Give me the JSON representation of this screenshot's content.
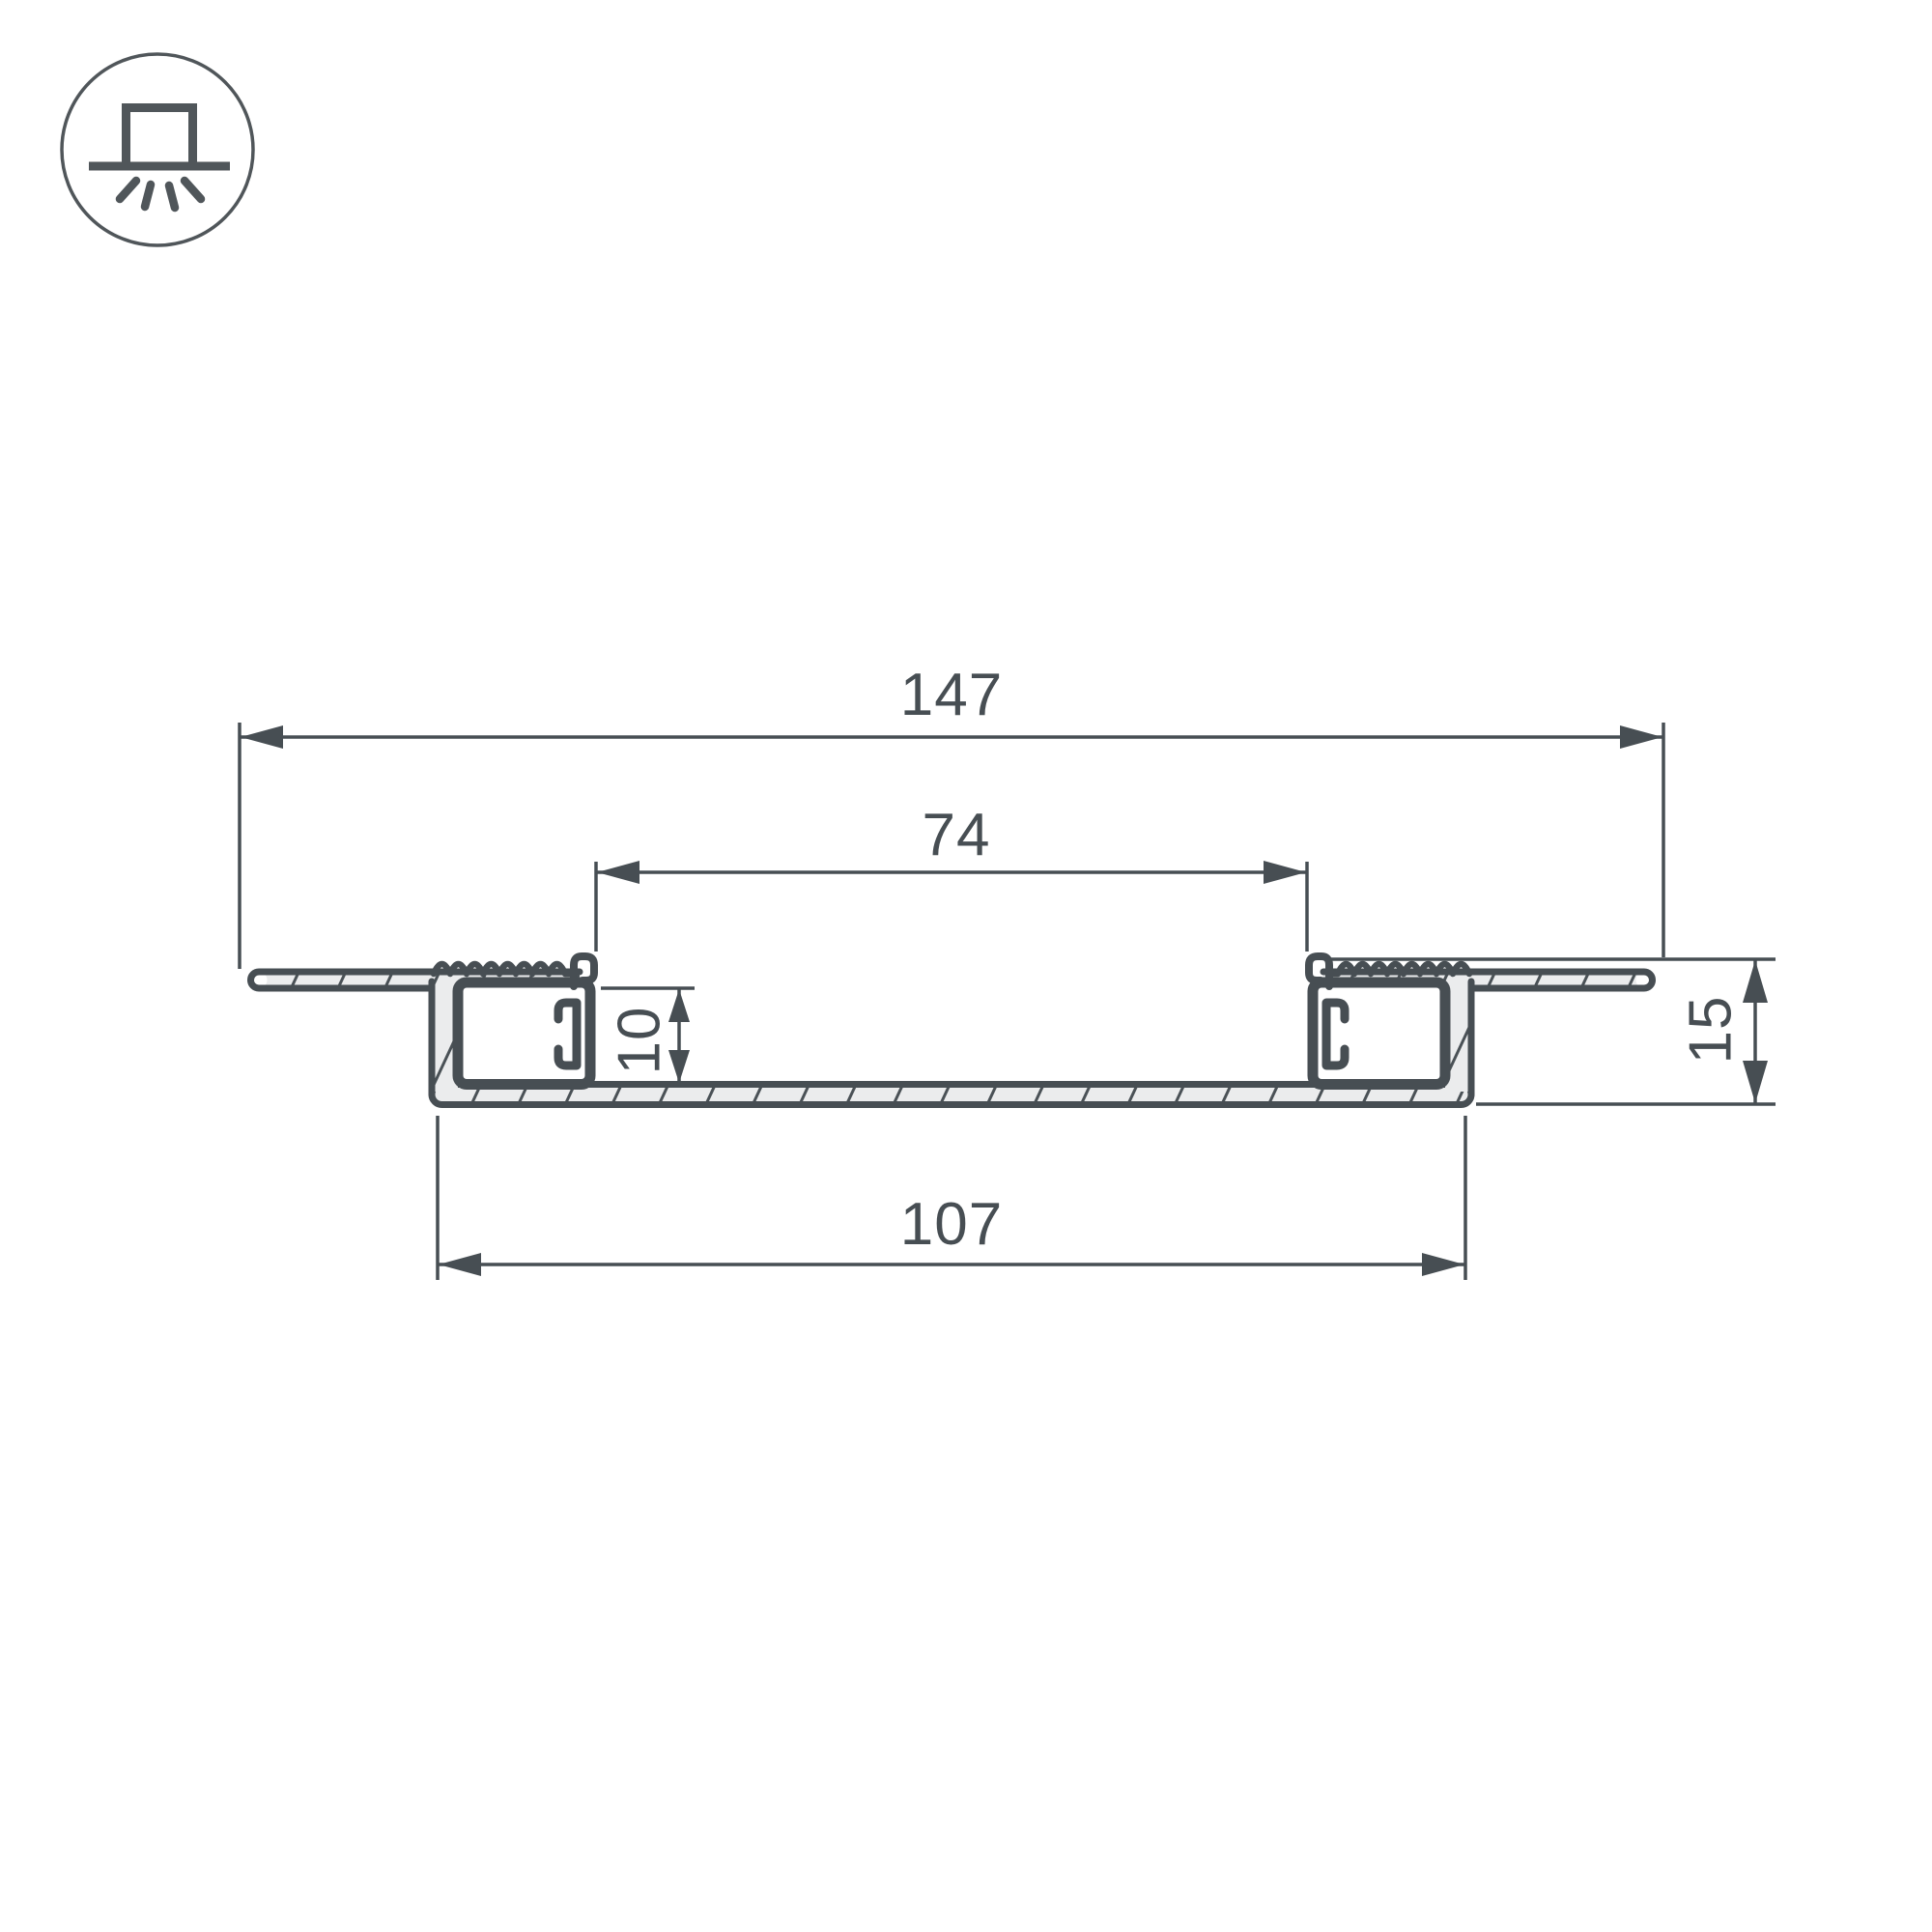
{
  "page": {
    "background": "#ffffff",
    "line_color": "#474e53",
    "profile_fill": "#ebeced",
    "cavity_fill": "#ffffff"
  },
  "icon": {
    "name": "recessed-light-icon",
    "meaning": "recessed downlight mounting symbol"
  },
  "drawing": {
    "type": "technical-cross-section",
    "subject": "recessed LED aluminium profile, section view",
    "dimensions": {
      "overall_width": "147",
      "inner_opening_width": "74",
      "channel_height": "10",
      "base_width": "107",
      "total_height": "15"
    }
  }
}
